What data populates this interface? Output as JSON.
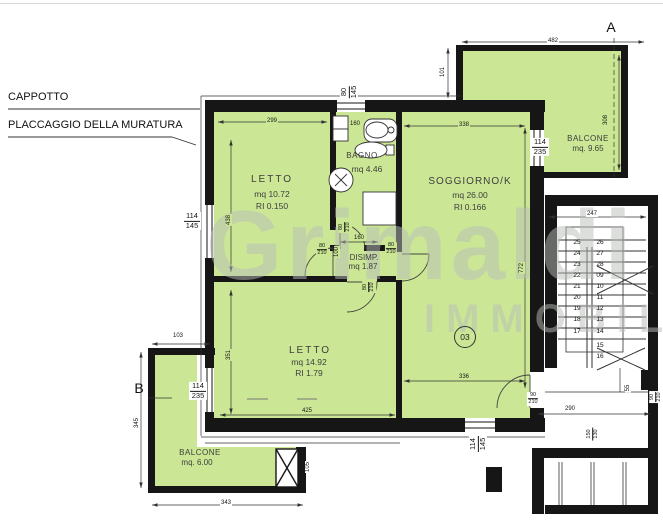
{
  "colors": {
    "room_fill": "#cbe795",
    "wall": "#161616",
    "watermark": "#b9beb9"
  },
  "notes": {
    "cappotto": "CAPPOTTO",
    "placcaggio": "PLACCAGGIO DELLA MURATURA"
  },
  "watermark": {
    "line1": "Grimaldi",
    "line2": "IMMOBILIARE"
  },
  "section_markers": {
    "a": "A",
    "b": "B"
  },
  "unit_badge": "03",
  "rooms": {
    "letto1": {
      "name": "LETTO",
      "area": "mq 10.72",
      "ri": "RI 0.150"
    },
    "bagno": {
      "name": "BAGNO",
      "area": "mq 4.46"
    },
    "soggiorno": {
      "name": "SOGGIORNO/K",
      "area": "mq 26.00",
      "ri": "RI 0.166"
    },
    "disimpegno": {
      "name": "DISIMP.",
      "area": "mq 1.87"
    },
    "letto2": {
      "name": "LETTO",
      "area": "mq 14.92",
      "ri": "RI 1.79"
    },
    "balcone_a": {
      "name": "BALCONE",
      "area": "mq. 9.65"
    },
    "balcone_b": {
      "name": "BALCONE",
      "area": "mq. 6.00"
    }
  },
  "dims": {
    "d482": "482",
    "d101": "101",
    "d308": "308",
    "d299": "299",
    "d338": "338",
    "d160_tub": "160",
    "d438": "438",
    "d247": "247",
    "d772": "772",
    "d160_disimp": "160",
    "d100": "100",
    "d103": "103",
    "d351": "351",
    "d345": "345",
    "d343": "343",
    "d425": "425",
    "d336": "336",
    "d290": "290",
    "d105": "105",
    "d55": "55",
    "w80_145": {
      "w": "80",
      "h": "145"
    },
    "w114_145_left": {
      "w": "114",
      "h": "145"
    },
    "w114_235_left": {
      "w": "114",
      "h": "235"
    },
    "w114_235_right": {
      "w": "114",
      "h": "235"
    },
    "w114_145_bottom": {
      "w": "114",
      "h": "145"
    },
    "door80_210": {
      "w": "80",
      "h": "210"
    },
    "door90_210": {
      "w": "90",
      "h": "210"
    },
    "d150_130": {
      "a": "150",
      "b": "130"
    }
  },
  "stairs": {
    "left": [
      "25",
      "24",
      "23",
      "22",
      "21",
      "20",
      "19",
      "18",
      "17"
    ],
    "right": [
      "26",
      "27",
      "28",
      "09",
      "10",
      "11",
      "12",
      "13",
      "14"
    ],
    "lower": [
      "15",
      "16"
    ]
  }
}
